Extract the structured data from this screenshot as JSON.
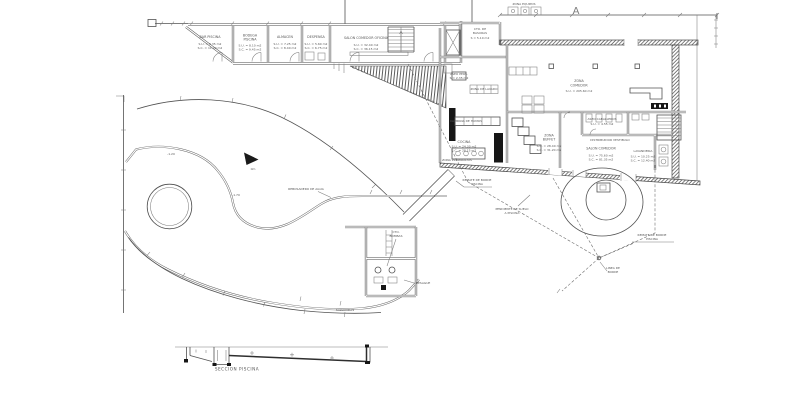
{
  "colors": {
    "line": "#474747",
    "light_line": "#7c7c7c",
    "text": "#565656",
    "fill_dark": "#161616",
    "background": "#ffffff"
  },
  "strip_rooms": [
    {
      "name": "BAR PISCINA",
      "su": "S.U. = 9.35 m2",
      "sc": "S.C. = 11.20 m2"
    },
    {
      "name": "BODEGA",
      "name2": "PISCINA",
      "su": "S.U. = 8.10 m2",
      "sc": "S.C. = 9.45 m2"
    },
    {
      "name": "ALMACEN",
      "su": "S.U. = 7.25 m2",
      "sc": "S.C. = 8.40 m2"
    },
    {
      "name": "DESPENSA",
      "su": "S.U. = 5.60 m2",
      "sc": "S.C. = 6.75 m2"
    },
    {
      "name": "SALON COMEDOR OFICINA",
      "su": "S.U. = 32.40 m2",
      "sc": "S.C. = 36.15 m2"
    }
  ],
  "building": {
    "cuarto_basuras": "CTO. DE",
    "cuarto_basuras2": "BASURAS",
    "cuarto_basuras_area": "S = 5.10 m2",
    "zona_equipos": "ZONA EQUIPOS",
    "section_marker": "A",
    "zona1": "ZONA",
    "zona2": "COMEDOR",
    "zona_area": "S.U. = 205.60 m2",
    "aseo_pers": "ASEO PERS.",
    "aseo_pers_area": "S = 2.35 m2",
    "zona_lavado": "ZONA DE LAVADO",
    "campana": "CAMPANA DE HUMOS",
    "cocina": "COCINA",
    "cocina_su": "S.U. = 24.30 m2",
    "cocina_sc": "S.C. = 28.15 m2",
    "preparados": "ZONA PREPARADOS",
    "buffet1": "ZONA",
    "buffet2": "BUFFET",
    "buffet_su": "S.U. = 28.40 m2",
    "buffet_sc": "S.C. = 31.20 m2",
    "aseo_cab": "ASEO CABALLEROS",
    "aseo_cab_area": "S.U. = 4.55 m2",
    "distribuidor": "DISTRIBUIDOR VESTIBULO",
    "salon": "SALON COMEDOR",
    "salon_su": "S.U. = 75.60 m2",
    "salon_sc": "S.C. = 81.35 m2",
    "lavanderia": "LAVANDERIA",
    "lav_su": "S.U. = 10.25 m2",
    "lav_sc": "S.C. = 12.40 m2"
  },
  "annotations": {
    "remate1a": "REMATE DE BORDE",
    "remate1b": "PISCINA",
    "pendiente1": "PENDIENTE DE SUELO",
    "pendiente2": "A PISCINA",
    "remate2a": "REMATE DE BORDE",
    "remate2b": "PISCINA",
    "linea1": "LINEA DE",
    "linea2": "BORDE",
    "rebosadero": "REBOSADERO DE AGUA",
    "cota1": "-1.20",
    "cota2": "-1.70",
    "cota3": "0m",
    "cto_bombas1": "CTO.",
    "cto_bombas2": "BOMBAS",
    "desague": "DESAGUE",
    "salvavidas": "SALVAVIDAS",
    "seccion": "SECCION PISCINA"
  }
}
